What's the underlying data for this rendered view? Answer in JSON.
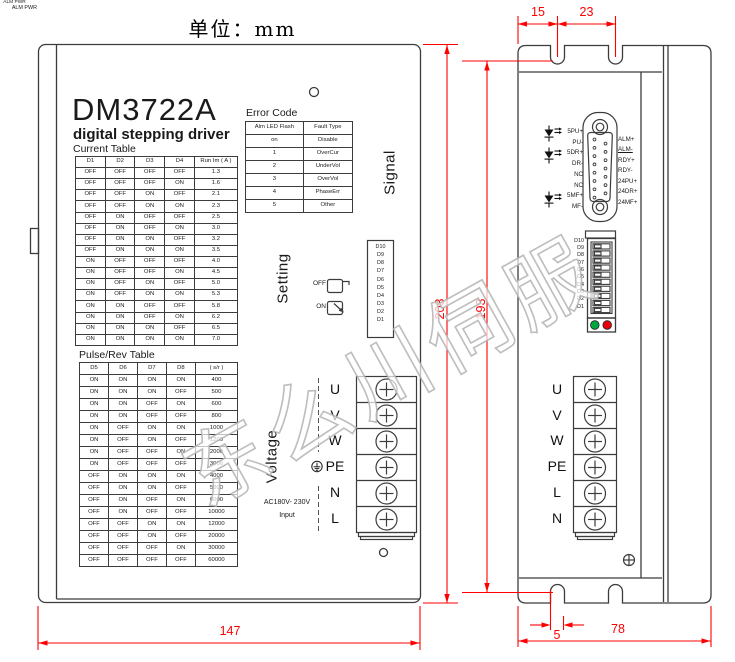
{
  "unit_label": "单位：mm",
  "watermark_text": "东么川伺服",
  "colors": {
    "line": "#3c3c3c",
    "dimension_red": "#fe0000",
    "led_green": "#00a63e",
    "led_red": "#e8000a"
  },
  "front_view": {
    "model": "DM3722A",
    "subtitle": "digital stepping driver",
    "signal_label": "Signal",
    "setting_label": "Setting",
    "voltage_label": "Voltage",
    "switch_off_label": "OFF",
    "switch_on_label": "ON",
    "ac_input_line1": "AC180V- 230V",
    "ac_input_line2": "Input",
    "dip_legend": [
      "D10",
      "D9",
      "D8",
      "D7",
      "D6",
      "D5",
      "D4",
      "D3",
      "D2",
      "D1"
    ],
    "dip_legend_bottom": "ALM PWR",
    "terminals": [
      "U",
      "V",
      "W",
      "PE",
      "N",
      "L"
    ],
    "current_table": {
      "title": "Current Table",
      "headers": [
        "D1",
        "D2",
        "D3",
        "D4",
        "Run Im ( A )"
      ],
      "rows": [
        [
          "OFF",
          "OFF",
          "OFF",
          "OFF",
          "1.3"
        ],
        [
          "OFF",
          "OFF",
          "OFF",
          "ON",
          "1.6"
        ],
        [
          "OFF",
          "OFF",
          "ON",
          "OFF",
          "2.1"
        ],
        [
          "OFF",
          "OFF",
          "ON",
          "ON",
          "2.3"
        ],
        [
          "OFF",
          "ON",
          "OFF",
          "OFF",
          "2.5"
        ],
        [
          "OFF",
          "ON",
          "OFF",
          "ON",
          "3.0"
        ],
        [
          "OFF",
          "ON",
          "ON",
          "OFF",
          "3.2"
        ],
        [
          "OFF",
          "ON",
          "ON",
          "ON",
          "3.5"
        ],
        [
          "ON",
          "OFF",
          "OFF",
          "OFF",
          "4.0"
        ],
        [
          "ON",
          "OFF",
          "OFF",
          "ON",
          "4.5"
        ],
        [
          "ON",
          "OFF",
          "ON",
          "OFF",
          "5.0"
        ],
        [
          "ON",
          "OFF",
          "ON",
          "ON",
          "5.3"
        ],
        [
          "ON",
          "ON",
          "OFF",
          "OFF",
          "5.8"
        ],
        [
          "ON",
          "ON",
          "OFF",
          "ON",
          "6.2"
        ],
        [
          "ON",
          "ON",
          "ON",
          "OFF",
          "6.5"
        ],
        [
          "ON",
          "ON",
          "ON",
          "ON",
          "7.0"
        ]
      ]
    },
    "pulse_table": {
      "title": "Pulse/Rev Table",
      "headers": [
        "D5",
        "D6",
        "D7",
        "D8",
        "( s/r )"
      ],
      "rows": [
        [
          "ON",
          "ON",
          "ON",
          "ON",
          "400"
        ],
        [
          "ON",
          "ON",
          "ON",
          "OFF",
          "500"
        ],
        [
          "ON",
          "ON",
          "OFF",
          "ON",
          "600"
        ],
        [
          "ON",
          "ON",
          "OFF",
          "OFF",
          "800"
        ],
        [
          "ON",
          "OFF",
          "ON",
          "ON",
          "1000"
        ],
        [
          "ON",
          "OFF",
          "ON",
          "OFF",
          "1200"
        ],
        [
          "ON",
          "OFF",
          "OFF",
          "ON",
          "2000"
        ],
        [
          "ON",
          "OFF",
          "OFF",
          "OFF",
          "3000"
        ],
        [
          "OFF",
          "ON",
          "ON",
          "ON",
          "4000"
        ],
        [
          "OFF",
          "ON",
          "ON",
          "OFF",
          "5000"
        ],
        [
          "OFF",
          "ON",
          "OFF",
          "ON",
          "6000"
        ],
        [
          "OFF",
          "ON",
          "OFF",
          "OFF",
          "10000"
        ],
        [
          "OFF",
          "OFF",
          "ON",
          "ON",
          "12000"
        ],
        [
          "OFF",
          "OFF",
          "ON",
          "OFF",
          "20000"
        ],
        [
          "OFF",
          "OFF",
          "OFF",
          "ON",
          "30000"
        ],
        [
          "OFF",
          "OFF",
          "OFF",
          "OFF",
          "60000"
        ]
      ]
    },
    "error_table": {
      "title": "Error Code",
      "headers": [
        "Alm LED Flash",
        "Fault Type"
      ],
      "rows": [
        [
          "on",
          "Disable"
        ],
        [
          "1",
          "OverCur"
        ],
        [
          "2",
          "UnderVol"
        ],
        [
          "3",
          "OverVol"
        ],
        [
          "4",
          "PhaseErr"
        ],
        [
          "5",
          "Other"
        ]
      ]
    }
  },
  "side_view": {
    "connector_pins_left": [
      "5PU+",
      "PU-",
      "5DR+",
      "DR-",
      "NC",
      "NC",
      "5MF+",
      "MF-"
    ],
    "connector_pins_right": [
      "ALM+",
      {
        "text": "ALM-",
        "underline": true
      },
      "RDY+",
      "RDY-",
      "24PU+",
      "24DR+",
      "24MF+"
    ],
    "dip_labels": [
      "D10",
      "D9",
      "D8",
      "D7",
      "D6",
      "D5",
      "D4",
      "D3",
      "D2",
      "D1"
    ],
    "led_label": "ALM PWR",
    "terminals": [
      "U",
      "V",
      "W",
      "PE",
      "L",
      "N"
    ]
  },
  "dimensions_mm": {
    "top_edge_to_slot": "15",
    "slot_to_slot": "23",
    "front_height": "203",
    "mounting_height": "193",
    "front_width": "147",
    "slot_width": "5",
    "side_width": "78"
  }
}
